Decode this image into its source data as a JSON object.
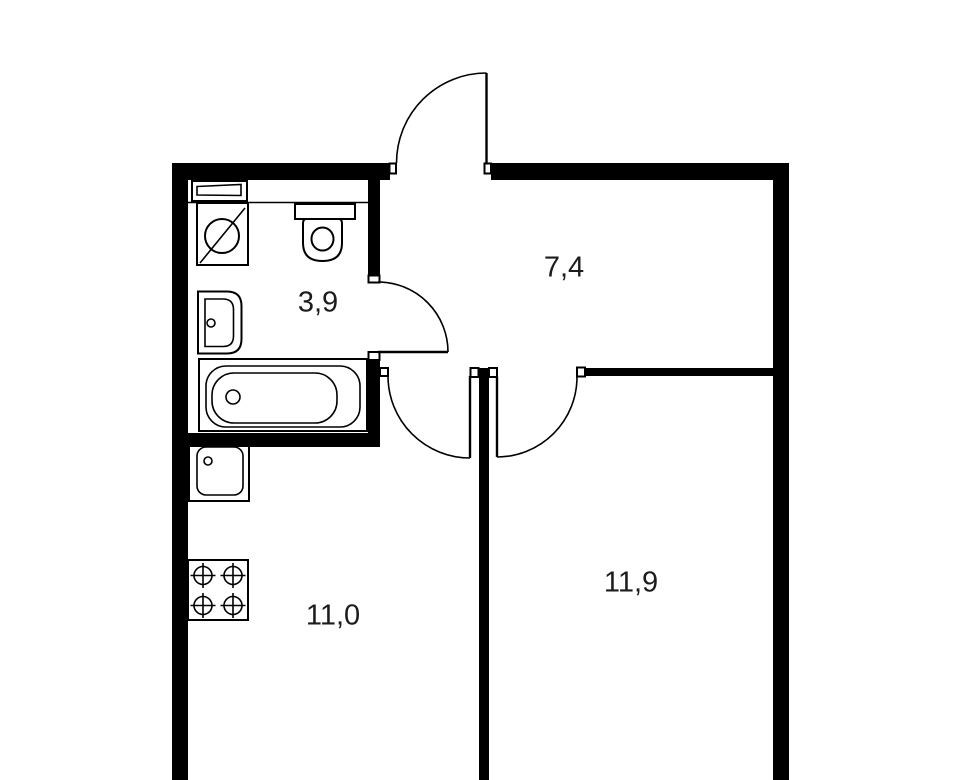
{
  "plan_type": "apartment-floor-plan",
  "colors": {
    "background": "#ffffff",
    "walls": "#000000",
    "fixture_lines": "#000000",
    "label_text": "#1c1c1c"
  },
  "rooms": [
    {
      "name": "bathroom",
      "area": "3,9"
    },
    {
      "name": "hallway",
      "area": "7,4"
    },
    {
      "name": "kitchen",
      "area": "11,0"
    },
    {
      "name": "living-room",
      "area": "11,9"
    }
  ],
  "fixtures": [
    "shelf",
    "washing-machine",
    "toilet",
    "wash-basin",
    "bathtub",
    "kitchen-sink",
    "stove-4-burners"
  ],
  "doors": [
    "entrance-door-top-opens-out",
    "bathroom-door-opens-to-hallway",
    "kitchen-door-opens-down-left",
    "room-door-opens-down-right"
  ]
}
